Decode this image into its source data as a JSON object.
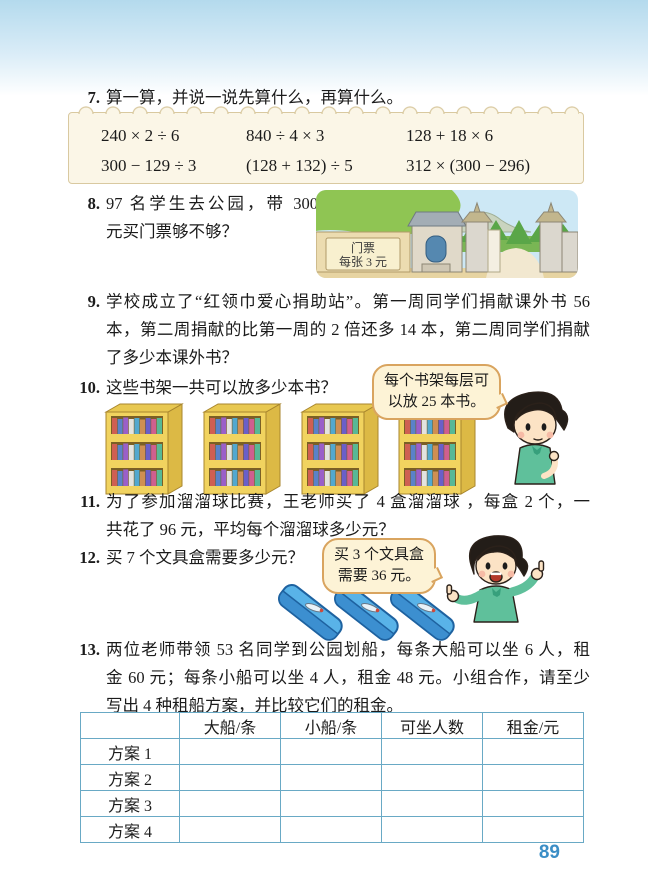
{
  "page_number": "89",
  "ex7": {
    "number": "7.",
    "title": "算一算，并说一说先算什么，再算什么。",
    "expressions": [
      "240 × 2 ÷ 6",
      "840 ÷ 4 × 3",
      "128 + 18 × 6",
      "300 − 129 ÷ 3",
      "(128 + 132) ÷ 5",
      "312 × (300 − 296)"
    ]
  },
  "ex8": {
    "number": "8.",
    "lines": [
      "97 名学生去公园，带 300",
      "元买门票够不够？"
    ],
    "sign": {
      "line1": "门票",
      "line2": "每张 3 元"
    }
  },
  "ex9": {
    "number": "9.",
    "lines": [
      "学校成立了“红领巾爱心捐助站”。第一周同学们捐献课外书 56",
      "本，第二周捐献的比第一周的 2 倍还多 14 本，第二周同学们捐献",
      "了多少本课外书？"
    ]
  },
  "ex10": {
    "number": "10.",
    "title": "这些书架一共可以放多少本书？",
    "bubble_lines": [
      "每个书架每层可",
      "以放 25 本书。"
    ]
  },
  "ex11": {
    "number": "11.",
    "lines": [
      "为了参加溜溜球比赛，王老师买了 4 盒溜溜球 ，每盒 2 个，一",
      "共花了 96 元，平均每个溜溜球多少元？"
    ]
  },
  "ex12": {
    "number": "12.",
    "title": "买 7 个文具盒需要多少元？",
    "bubble_lines": [
      "买 3 个文具盒",
      "需要 36 元。"
    ]
  },
  "ex13": {
    "number": "13.",
    "lines": [
      "两位老师带领 53 名同学到公园划船，每条大船可以坐 6 人，租",
      "金 60 元；每条小船可以坐 4 人，租金 48 元。小组合作，请至少",
      "写出 4 种租船方案，并比较它们的租金。"
    ],
    "table": {
      "headers": [
        "",
        "大船/条",
        "小船/条",
        "可坐人数",
        "租金/元"
      ],
      "row_labels": [
        "方案 1",
        "方案 2",
        "方案 3",
        "方案 4"
      ]
    }
  },
  "colors": {
    "page_number_blue": "#3b8ec6",
    "table_border": "#69a9c5",
    "bubble_fill": "#fdf3d6",
    "bubble_border": "#d9a45f",
    "panel_cream": "#fbf6e7",
    "shelf_yellow": "#f1d35f",
    "pencil_box_blue": "#59b3e8",
    "shirt_green": "#5fc09b"
  }
}
